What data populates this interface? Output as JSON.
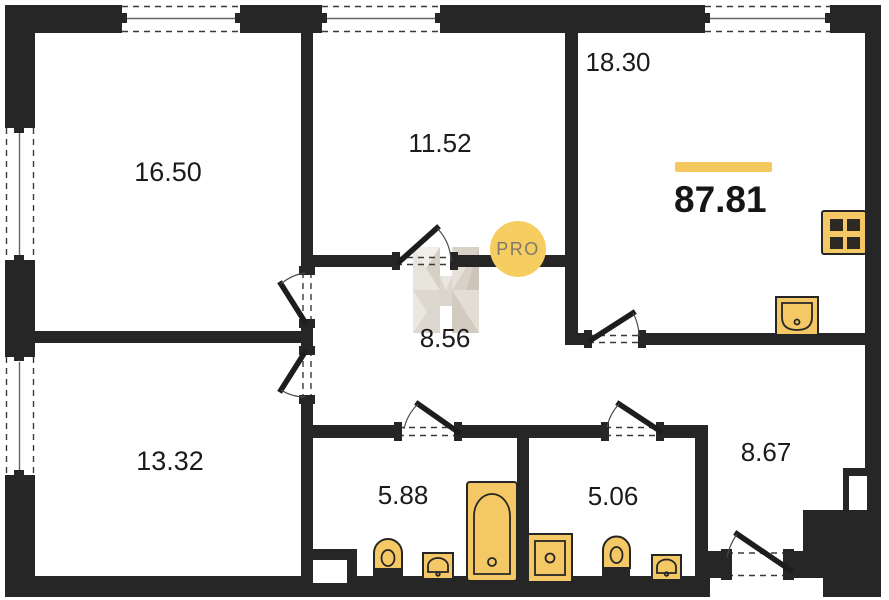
{
  "plan": {
    "total": {
      "area": "87.81"
    },
    "rooms": [
      {
        "name": "bedroom-top-left",
        "area": "16.50"
      },
      {
        "name": "bedroom-top-middle",
        "area": "11.52"
      },
      {
        "name": "living-kitchen",
        "area": "18.30"
      },
      {
        "name": "hallway",
        "area": "8.56"
      },
      {
        "name": "bedroom-bottom-left",
        "area": "13.32"
      },
      {
        "name": "bathroom",
        "area": "5.88"
      },
      {
        "name": "wc",
        "area": "5.06"
      },
      {
        "name": "entry-hall",
        "area": "8.67"
      }
    ],
    "watermark": {
      "badge_label": "PRO"
    },
    "colors": {
      "wall": "#262626",
      "fixture_fill": "#F5C866",
      "accent_bar": "#F5C75F",
      "badge_bg": "#F6CD60",
      "badge_text": "#80786A",
      "watermark_light": "#EAE6E0",
      "watermark_dark": "#CCC4B8"
    }
  }
}
